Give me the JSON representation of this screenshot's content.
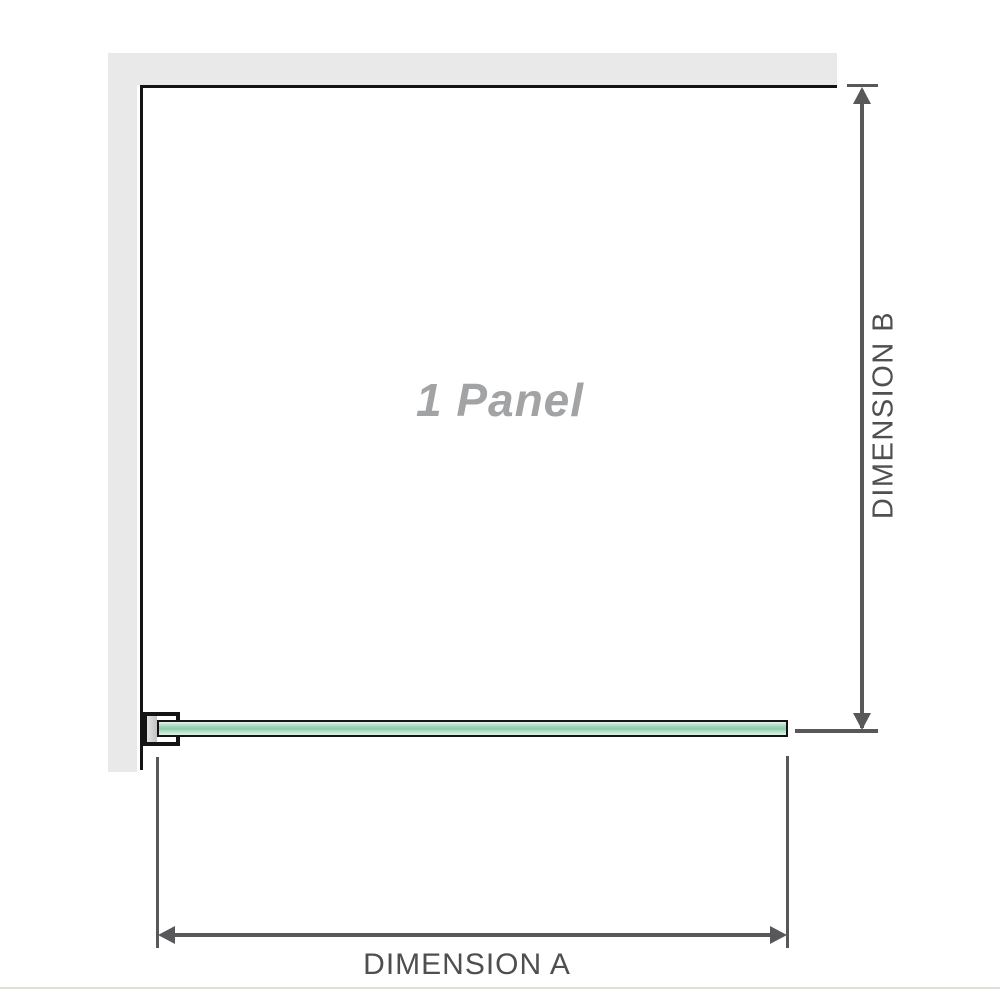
{
  "diagram": {
    "watermark_label": "1 Panel",
    "dimension_a_label": "DIMENSION A",
    "dimension_b_label": "DIMENSION B"
  },
  "colors": {
    "wall": "#e9e9e9",
    "outline": "#141414",
    "dimension": "#58585a",
    "label_text": "#4d4f50",
    "watermark": "#a2a3a5",
    "glass_light": "#e4f3ea",
    "glass_mid": "#a6d9bd",
    "glass_dark": "#8bcbaa",
    "baseline_rule": "#e1e1d9"
  },
  "icons": [
    {
      "name": "arrow-up-icon",
      "meaning": "dimension B upper end arrowhead"
    },
    {
      "name": "arrow-down-icon",
      "meaning": "dimension B lower end arrowhead"
    },
    {
      "name": "arrow-left-icon",
      "meaning": "dimension A left end arrowhead"
    },
    {
      "name": "arrow-right-icon",
      "meaning": "dimension A right end arrowhead"
    }
  ]
}
